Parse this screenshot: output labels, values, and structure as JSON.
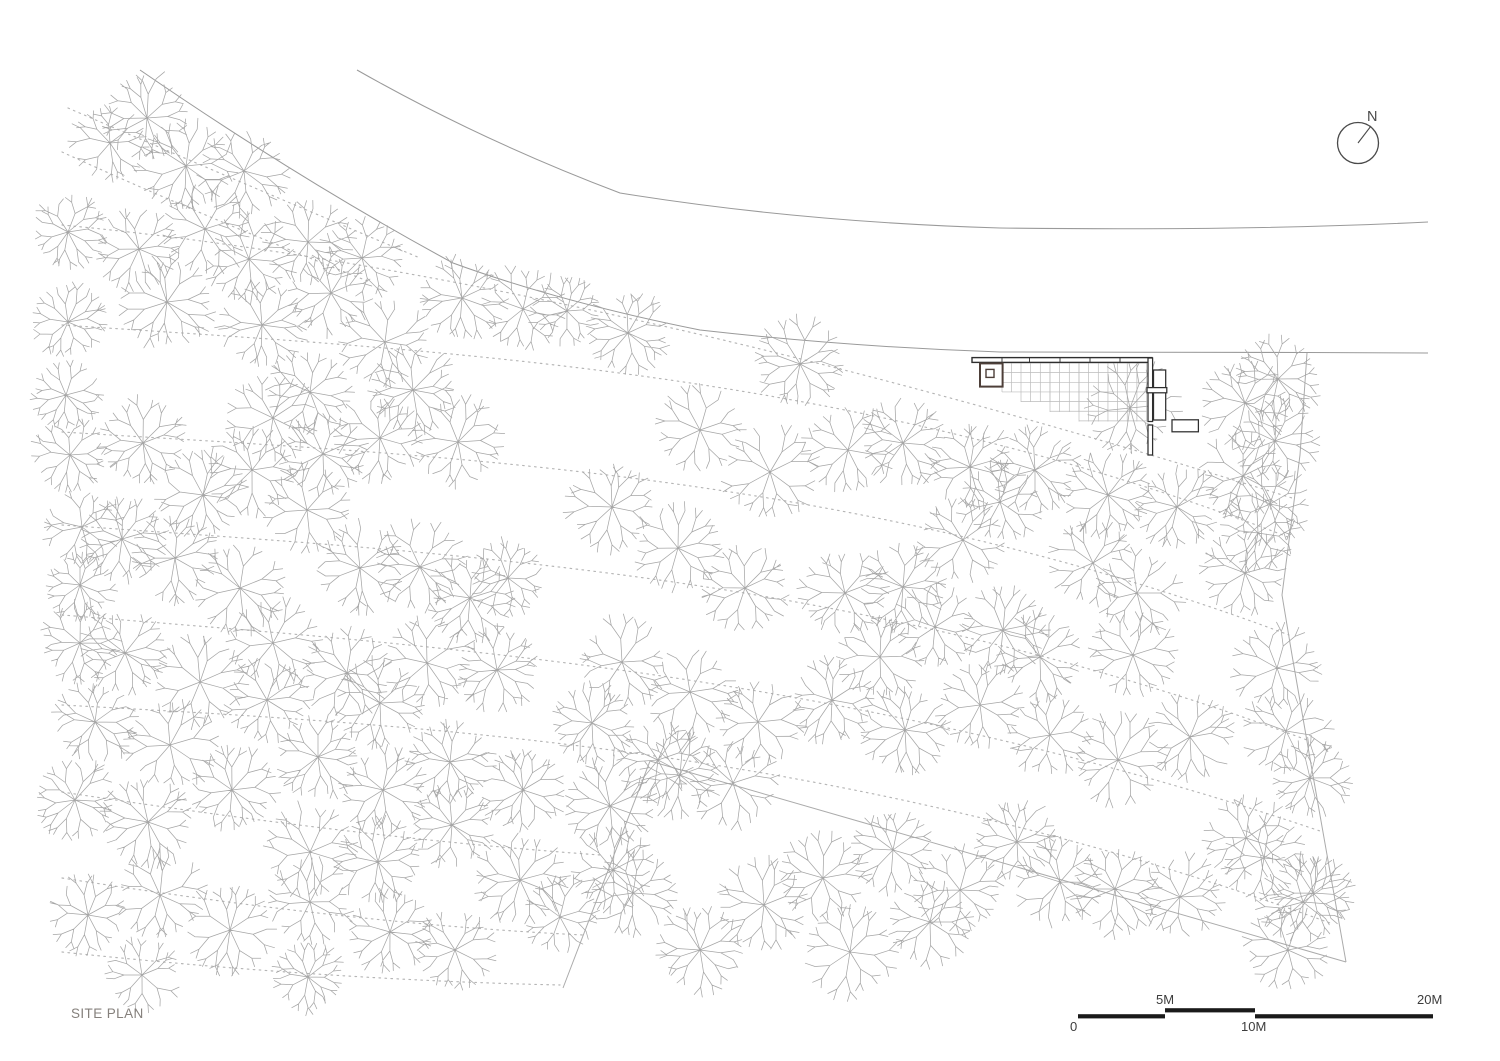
{
  "title": {
    "label": "SITE PLAN"
  },
  "north_arrow": {
    "label": "N",
    "cx": 1358,
    "cy": 143,
    "r": 20.5,
    "needle_dx": 13,
    "needle_dy": -17
  },
  "scale_bar": {
    "labels": {
      "zero": "0",
      "five": "5M",
      "ten": "10M",
      "twenty": "20M"
    },
    "segments": [
      {
        "x": 1078,
        "y": 1014.2,
        "w": 87,
        "h": 4.2
      },
      {
        "x": 1165,
        "y": 1008.2,
        "w": 90,
        "h": 4.2
      },
      {
        "x": 1255,
        "y": 1014.2,
        "w": 178,
        "h": 4.2
      }
    ],
    "label_pos": {
      "zero": [
        1070,
        1019
      ],
      "five": [
        1156,
        992
      ],
      "ten": [
        1241,
        1019
      ],
      "twenty": [
        1417,
        992
      ]
    }
  },
  "colors": {
    "ink": "#2e2e2e",
    "room": "#4d3f39",
    "grid": "#bcbcbc",
    "tree": "#a6a6a6",
    "contour": "#b5b5b5",
    "road": "#9a9a9a",
    "boundary": "#ababab",
    "bar_black": "#1a1a1a",
    "north": "#4a4a4a"
  },
  "roads": [
    "M140,70 Q300,180 453,263 Q560,302 700,330 Q850,347 1000,352 L1307,352.5 L1428,353",
    "M357,70 Q480,140 620,193 Q800,222 1000,228 Q1250,231 1428,222"
  ],
  "boundaries": [
    "M1307,353 L1300,455 L1282,595 L1292,655 L1312,770 L1346,962",
    "M1346,962 L650,761",
    "M650,761 L563,988"
  ],
  "contours": [
    "M68,108 Q200,165 420,258",
    "M62,152 Q200,215 370,282",
    "M62,225 C430,260 850,360 1292,498",
    "M62,325 C430,350 850,368 1288,537",
    "M62,432 C430,455 850,470 1289,635",
    "M62,525 C430,552 850,570 1307,740",
    "M62,615 C430,645 850,672 1323,832",
    "M62,705 C430,725 850,748 1330,923",
    "M62,792 C300,828 460,845 600,855",
    "M62,878 C280,912 440,928 583,935",
    "M62,952 C250,972 420,982 560,985"
  ],
  "building": {
    "bar": {
      "x": 972,
      "y": 357.6,
      "w": 180,
      "h": 4.8
    },
    "bar_ticks": [
      1002,
      1029.5,
      1060,
      1090,
      1120,
      1149.5
    ],
    "room": {
      "x": 980,
      "y": 363.4,
      "w": 22.6,
      "h": 23.2
    },
    "room_inner": {
      "x": 986,
      "y": 369.4,
      "w": 8,
      "h": 8
    },
    "grid_origin": {
      "x": 1002,
      "y": 363
    },
    "grid_cell": 9.65,
    "grid_steps": [
      {
        "x0": 1002,
        "x1": 1021,
        "yb": 392
      },
      {
        "x0": 1021,
        "x1": 1050,
        "yb": 402
      },
      {
        "x0": 1050,
        "x1": 1079,
        "yb": 412
      },
      {
        "x0": 1079,
        "x1": 1147,
        "yb": 421.5
      }
    ],
    "dark_rects": [
      {
        "x": 1148,
        "y": 358,
        "w": 4.6,
        "h": 63.5
      },
      {
        "x": 1148,
        "y": 425,
        "w": 4.6,
        "h": 30
      },
      {
        "x": 1153.5,
        "y": 370,
        "w": 12.2,
        "h": 50
      },
      {
        "x": 1147,
        "y": 387.6,
        "w": 19.8,
        "h": 5.2
      },
      {
        "x": 1172,
        "y": 419.8,
        "w": 26.4,
        "h": 12
      }
    ]
  },
  "trees": [
    [
      147,
      118,
      44
    ],
    [
      110,
      143,
      38
    ],
    [
      186,
      166,
      46
    ],
    [
      244,
      171,
      42
    ],
    [
      68,
      232,
      36
    ],
    [
      139,
      249,
      40
    ],
    [
      205,
      229,
      44
    ],
    [
      249,
      259,
      42
    ],
    [
      308,
      242,
      44
    ],
    [
      362,
      258,
      40
    ],
    [
      68,
      322,
      36
    ],
    [
      167,
      302,
      44
    ],
    [
      262,
      325,
      42
    ],
    [
      331,
      293,
      40
    ],
    [
      385,
      342,
      44
    ],
    [
      462,
      298,
      40
    ],
    [
      523,
      309,
      42
    ],
    [
      567,
      311,
      34
    ],
    [
      66,
      395,
      34
    ],
    [
      70,
      455,
      36
    ],
    [
      143,
      443,
      42
    ],
    [
      273,
      418,
      44
    ],
    [
      310,
      392,
      40
    ],
    [
      413,
      390,
      42
    ],
    [
      252,
      470,
      44
    ],
    [
      323,
      454,
      40
    ],
    [
      380,
      438,
      42
    ],
    [
      458,
      442,
      44
    ],
    [
      203,
      495,
      42
    ],
    [
      82,
      527,
      38
    ],
    [
      122,
      539,
      40
    ],
    [
      175,
      558,
      42
    ],
    [
      240,
      588,
      46
    ],
    [
      307,
      510,
      44
    ],
    [
      360,
      568,
      42
    ],
    [
      420,
      567,
      44
    ],
    [
      470,
      598,
      40
    ],
    [
      508,
      578,
      36
    ],
    [
      80,
      585,
      34
    ],
    [
      80,
      643,
      38
    ],
    [
      125,
      653,
      42
    ],
    [
      200,
      682,
      46
    ],
    [
      273,
      643,
      44
    ],
    [
      347,
      673,
      44
    ],
    [
      427,
      663,
      44
    ],
    [
      497,
      670,
      40
    ],
    [
      267,
      700,
      40
    ],
    [
      380,
      703,
      42
    ],
    [
      95,
      722,
      40
    ],
    [
      170,
      745,
      44
    ],
    [
      318,
      757,
      40
    ],
    [
      75,
      800,
      40
    ],
    [
      148,
      822,
      44
    ],
    [
      232,
      790,
      42
    ],
    [
      310,
      852,
      46
    ],
    [
      383,
      790,
      42
    ],
    [
      450,
      762,
      40
    ],
    [
      160,
      895,
      44
    ],
    [
      88,
      915,
      38
    ],
    [
      230,
      930,
      44
    ],
    [
      310,
      902,
      42
    ],
    [
      390,
      932,
      40
    ],
    [
      142,
      975,
      36
    ],
    [
      308,
      977,
      34
    ],
    [
      455,
      950,
      40
    ],
    [
      378,
      862,
      42
    ],
    [
      452,
      825,
      40
    ],
    [
      520,
      880,
      44
    ],
    [
      560,
      917,
      38
    ],
    [
      523,
      790,
      40
    ],
    [
      610,
      806,
      44
    ],
    [
      613,
      870,
      40
    ],
    [
      633,
      893,
      42
    ],
    [
      700,
      950,
      42
    ],
    [
      764,
      905,
      44
    ],
    [
      850,
      952,
      44
    ],
    [
      930,
      922,
      42
    ],
    [
      823,
      878,
      42
    ],
    [
      680,
      775,
      40
    ],
    [
      733,
      783,
      42
    ],
    [
      893,
      850,
      40
    ],
    [
      960,
      890,
      40
    ],
    [
      1017,
      842,
      40
    ],
    [
      1060,
      882,
      42
    ],
    [
      1115,
      889,
      44
    ],
    [
      1180,
      897,
      42
    ],
    [
      1288,
      950,
      40
    ],
    [
      1313,
      893,
      40
    ],
    [
      1278,
      379,
      40
    ],
    [
      1245,
      403,
      42
    ],
    [
      1275,
      441,
      40
    ],
    [
      1243,
      476,
      42
    ],
    [
      1270,
      504,
      40
    ],
    [
      1258,
      533,
      38
    ],
    [
      1245,
      573,
      40
    ],
    [
      1277,
      668,
      42
    ],
    [
      1286,
      731,
      42
    ],
    [
      1310,
      778,
      40
    ],
    [
      1246,
      838,
      42
    ],
    [
      1264,
      858,
      40
    ],
    [
      1303,
      902,
      42
    ],
    [
      628,
      333,
      40
    ],
    [
      800,
      364,
      44
    ],
    [
      848,
      450,
      42
    ],
    [
      903,
      443,
      44
    ],
    [
      970,
      467,
      42
    ],
    [
      1035,
      470,
      42
    ],
    [
      1130,
      408,
      46
    ],
    [
      700,
      430,
      42
    ],
    [
      770,
      472,
      44
    ],
    [
      1108,
      495,
      42
    ],
    [
      1177,
      507,
      40
    ],
    [
      963,
      540,
      44
    ],
    [
      1000,
      502,
      40
    ],
    [
      1093,
      563,
      42
    ],
    [
      845,
      593,
      42
    ],
    [
      903,
      587,
      42
    ],
    [
      1137,
      593,
      42
    ],
    [
      935,
      627,
      42
    ],
    [
      1003,
      630,
      42
    ],
    [
      1040,
      657,
      42
    ],
    [
      1133,
      655,
      42
    ],
    [
      880,
      657,
      40
    ],
    [
      612,
      507,
      42
    ],
    [
      678,
      548,
      42
    ],
    [
      745,
      588,
      42
    ],
    [
      622,
      662,
      42
    ],
    [
      690,
      692,
      44
    ],
    [
      758,
      722,
      42
    ],
    [
      592,
      723,
      38
    ],
    [
      832,
      700,
      40
    ],
    [
      905,
      730,
      44
    ],
    [
      980,
      705,
      42
    ],
    [
      1050,
      735,
      40
    ],
    [
      1118,
      760,
      44
    ],
    [
      1190,
      737,
      42
    ],
    [
      658,
      760,
      40
    ]
  ]
}
